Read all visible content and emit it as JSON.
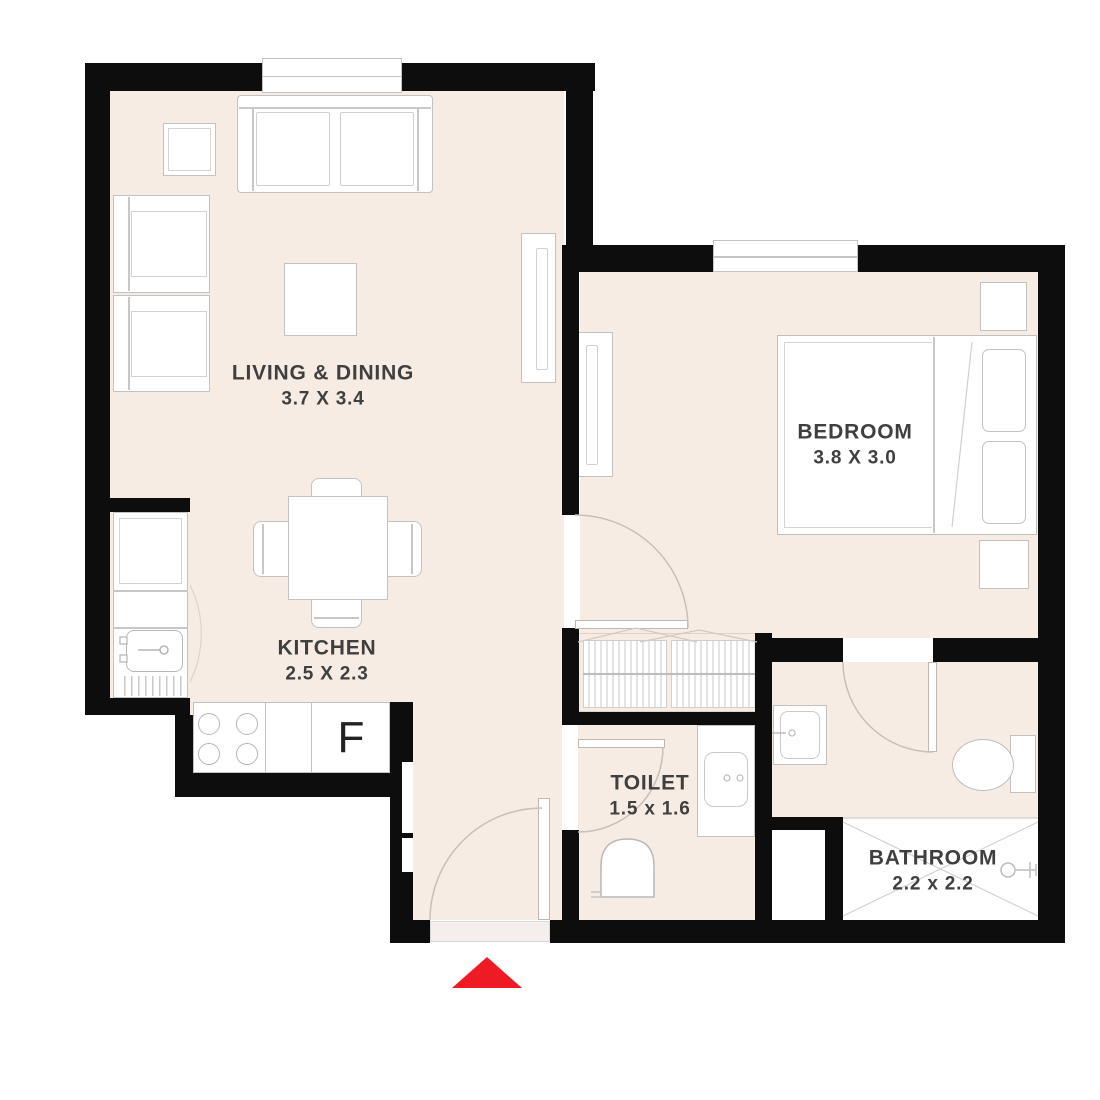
{
  "plan": {
    "rooms": [
      {
        "name": "LIVING & DINING",
        "dims": "3.7 X 3.4"
      },
      {
        "name": "BEDROOM",
        "dims": "3.8 X 3.0"
      },
      {
        "name": "KITCHEN",
        "dims": "2.5 X 2.3"
      },
      {
        "name": "TOILET",
        "dims": "1.5 x 1.6"
      },
      {
        "name": "BATHROOM",
        "dims": "2.2 x 2.2"
      }
    ],
    "appliances": {
      "fridge_label": "F"
    },
    "colors": {
      "wall": "#0d0d0d",
      "floor": "#f7ece4",
      "outline": "#c2c2c2",
      "entrance_arrow": "#ee1b24",
      "text": "#3f3f3f"
    }
  }
}
